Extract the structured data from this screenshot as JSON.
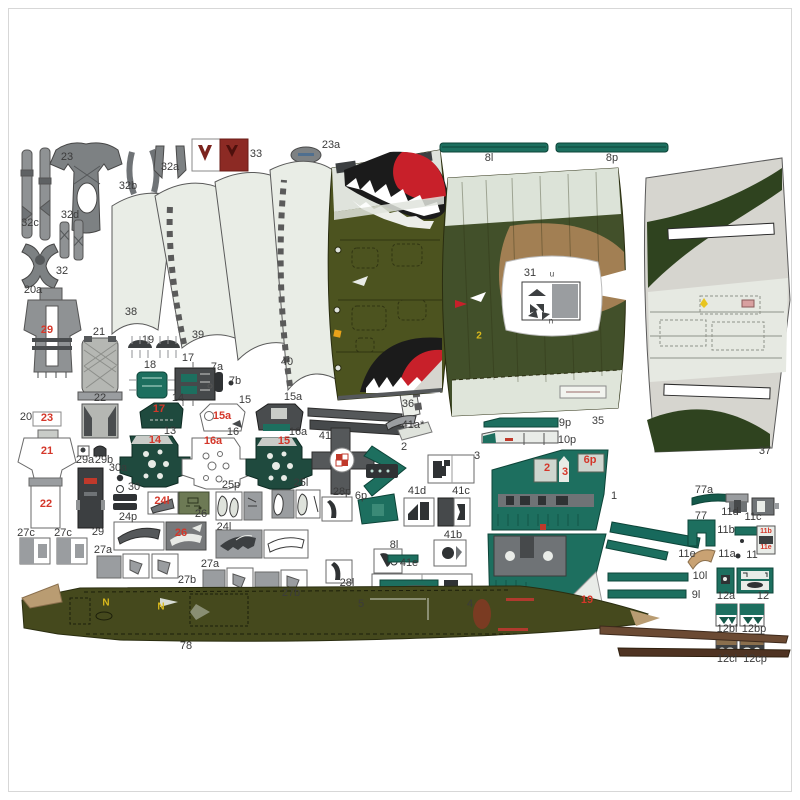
{
  "sheet": {
    "kind": "card-model-parts-sheet",
    "subject": "jet aircraft paper model parts with shark-mouth nose art, camouflage skins, cockpit consoles and numbered cut-out parts"
  },
  "colors": {
    "teal_part": "#1d6f5f",
    "olive_skin": "#4c531f",
    "camo_green": "#42502a",
    "camo_tan": "#a27f53",
    "bare_gray": "#d6d5cf",
    "part_gray": "#9a9da0",
    "dark_gray": "#46494b",
    "shark_red": "#c8202a",
    "printed_red": "#d4372a",
    "printed_yellow": "#d9b91c",
    "dark_red_part": "#8c2a24"
  },
  "labels": [
    {
      "t": "23",
      "x": 67,
      "y": 158
    },
    {
      "t": "32c",
      "x": 30,
      "y": 224
    },
    {
      "t": "32b",
      "x": 128,
      "y": 187
    },
    {
      "t": "32a",
      "x": 170,
      "y": 168
    },
    {
      "t": "33",
      "x": 256,
      "y": 155
    },
    {
      "t": "23a",
      "x": 331,
      "y": 146
    },
    {
      "t": "32d",
      "x": 70,
      "y": 216
    },
    {
      "t": "32",
      "x": 62,
      "y": 272
    },
    {
      "t": "8l",
      "x": 489,
      "y": 159
    },
    {
      "t": "8p",
      "x": 612,
      "y": 159
    },
    {
      "t": "20a",
      "x": 33,
      "y": 291
    },
    {
      "t": "38",
      "x": 131,
      "y": 313
    },
    {
      "t": "39",
      "x": 198,
      "y": 336
    },
    {
      "t": "40",
      "x": 287,
      "y": 363
    },
    {
      "t": "21",
      "x": 99,
      "y": 333
    },
    {
      "t": "22",
      "x": 100,
      "y": 399
    },
    {
      "t": "19",
      "x": 148,
      "y": 341
    },
    {
      "t": "18",
      "x": 150,
      "y": 366
    },
    {
      "t": "17",
      "x": 188,
      "y": 359
    },
    {
      "t": "7a",
      "x": 217,
      "y": 368
    },
    {
      "t": "7b",
      "x": 235,
      "y": 382
    },
    {
      "t": "14",
      "x": 178,
      "y": 399
    },
    {
      "t": "15",
      "x": 245,
      "y": 401
    },
    {
      "t": "15a",
      "x": 293,
      "y": 398
    },
    {
      "t": "36",
      "x": 408,
      "y": 405
    },
    {
      "t": "35",
      "x": 598,
      "y": 422
    },
    {
      "t": "31",
      "x": 530,
      "y": 274
    },
    {
      "t": "u",
      "x": 552,
      "y": 275,
      "s": "sm"
    },
    {
      "t": "n",
      "x": 551,
      "y": 322,
      "s": "sm"
    },
    {
      "t": "37",
      "x": 765,
      "y": 452
    },
    {
      "t": "20",
      "x": 26,
      "y": 418
    },
    {
      "t": "13",
      "x": 170,
      "y": 432
    },
    {
      "t": "16",
      "x": 233,
      "y": 433
    },
    {
      "t": "16a",
      "x": 298,
      "y": 433
    },
    {
      "t": "29a",
      "x": 85,
      "y": 461
    },
    {
      "t": "29b",
      "x": 104,
      "y": 461
    },
    {
      "t": "30a",
      "x": 118,
      "y": 469
    },
    {
      "t": "30",
      "x": 134,
      "y": 488
    },
    {
      "t": "29",
      "x": 98,
      "y": 533
    },
    {
      "t": "41",
      "x": 325,
      "y": 437
    },
    {
      "t": "41a*",
      "x": 413,
      "y": 426
    },
    {
      "t": "2",
      "x": 404,
      "y": 448
    },
    {
      "t": "3",
      "x": 477,
      "y": 457
    },
    {
      "t": "9p",
      "x": 565,
      "y": 424
    },
    {
      "t": "10p",
      "x": 567,
      "y": 441
    },
    {
      "t": "1",
      "x": 614,
      "y": 497
    },
    {
      "t": "25p",
      "x": 231,
      "y": 486
    },
    {
      "t": "25l",
      "x": 301,
      "y": 484
    },
    {
      "t": "26",
      "x": 201,
      "y": 515
    },
    {
      "t": "24p",
      "x": 128,
      "y": 518
    },
    {
      "t": "24l",
      "x": 224,
      "y": 528
    },
    {
      "t": "27a",
      "x": 103,
      "y": 551
    },
    {
      "t": "27b",
      "x": 187,
      "y": 581
    },
    {
      "t": "27a",
      "x": 210,
      "y": 565
    },
    {
      "t": "27b",
      "x": 291,
      "y": 594
    },
    {
      "t": "27c",
      "x": 26,
      "y": 534
    },
    {
      "t": "27c",
      "x": 63,
      "y": 534
    },
    {
      "t": "28p",
      "x": 342,
      "y": 493
    },
    {
      "t": "6p",
      "x": 361,
      "y": 497
    },
    {
      "t": "41d",
      "x": 417,
      "y": 492
    },
    {
      "t": "41c",
      "x": 461,
      "y": 492
    },
    {
      "t": "41b",
      "x": 453,
      "y": 536
    },
    {
      "t": "8l",
      "x": 394,
      "y": 546
    },
    {
      "t": "28l",
      "x": 347,
      "y": 584
    },
    {
      "t": "5",
      "x": 361,
      "y": 605
    },
    {
      "t": "4",
      "x": 470,
      "y": 605
    },
    {
      "t": "41e",
      "x": 409,
      "y": 564
    },
    {
      "t": "78",
      "x": 186,
      "y": 647
    },
    {
      "t": "77a",
      "x": 704,
      "y": 491
    },
    {
      "t": "77",
      "x": 701,
      "y": 517
    },
    {
      "t": "11d",
      "x": 730,
      "y": 513
    },
    {
      "t": "11c",
      "x": 753,
      "y": 518
    },
    {
      "t": "11b",
      "x": 726,
      "y": 531
    },
    {
      "t": "11a",
      "x": 727,
      "y": 555
    },
    {
      "t": "11",
      "x": 752,
      "y": 556
    },
    {
      "t": "11e",
      "x": 687,
      "y": 555
    },
    {
      "t": "12a",
      "x": 726,
      "y": 597
    },
    {
      "t": "12",
      "x": 763,
      "y": 597
    },
    {
      "t": "12bl",
      "x": 727,
      "y": 630
    },
    {
      "t": "12bp",
      "x": 754,
      "y": 630
    },
    {
      "t": "12cl",
      "x": 727,
      "y": 660
    },
    {
      "t": "12cp",
      "x": 755,
      "y": 660
    },
    {
      "t": "10l",
      "x": 700,
      "y": 577
    },
    {
      "t": "9l",
      "x": 696,
      "y": 596
    },
    {
      "t": "29",
      "x": 47,
      "y": 331,
      "s": "r"
    },
    {
      "t": "23",
      "x": 47,
      "y": 419,
      "s": "r"
    },
    {
      "t": "21",
      "x": 47,
      "y": 452,
      "s": "r"
    },
    {
      "t": "22",
      "x": 46,
      "y": 505,
      "s": "r"
    },
    {
      "t": "17",
      "x": 159,
      "y": 410,
      "s": "r"
    },
    {
      "t": "15a",
      "x": 222,
      "y": 417,
      "s": "r"
    },
    {
      "t": "14",
      "x": 155,
      "y": 441,
      "s": "r"
    },
    {
      "t": "16a",
      "x": 213,
      "y": 442,
      "s": "r"
    },
    {
      "t": "15",
      "x": 284,
      "y": 442,
      "s": "r"
    },
    {
      "t": "24l",
      "x": 162,
      "y": 502,
      "s": "r"
    },
    {
      "t": "26",
      "x": 181,
      "y": 534,
      "s": "r"
    },
    {
      "t": "2",
      "x": 547,
      "y": 469,
      "s": "r"
    },
    {
      "t": "3",
      "x": 565,
      "y": 473,
      "s": "r"
    },
    {
      "t": "6p",
      "x": 590,
      "y": 461,
      "s": "r"
    },
    {
      "t": "19",
      "x": 587,
      "y": 601,
      "s": "r"
    },
    {
      "t": "11b",
      "x": 766,
      "y": 532,
      "s": "rt"
    },
    {
      "t": "11e",
      "x": 766,
      "y": 548,
      "s": "rt"
    },
    {
      "t": "N",
      "x": 106,
      "y": 604,
      "s": "y"
    },
    {
      "t": "N",
      "x": 161,
      "y": 608,
      "s": "y"
    },
    {
      "t": "2",
      "x": 479,
      "y": 337,
      "s": "y"
    }
  ]
}
